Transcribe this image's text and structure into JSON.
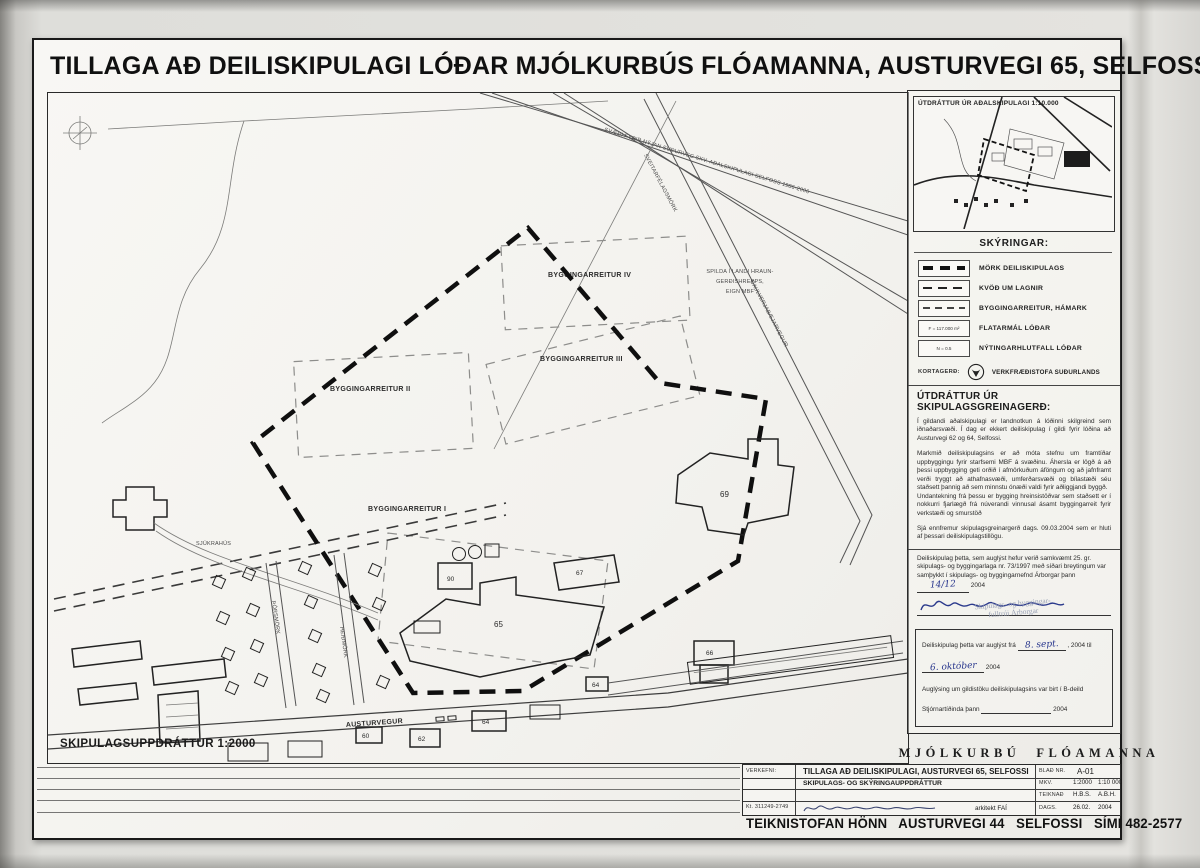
{
  "sheet": {
    "title": "TILLAGA AÐ DEILISKIPULAGI LÓÐAR MJÓLKURBÚS FLÓAMANNA, AUSTURVEGI 65, SELFOSSI"
  },
  "map": {
    "scale_label": "SKIPULAGSUPPDRÁTTUR 1:2000",
    "labels": {
      "byggingarreitur_1": "BYGGINGARREITUR I",
      "byggingarreitur_2": "BYGGINGARREITUR II",
      "byggingarreitur_3": "BYGGINGARREITUR III",
      "byggingarreitur_4": "BYGGINGARREITUR IV",
      "spilda_1": "SPILDA Í LANDI HRAUN-",
      "spilda_2": "GERÐISHREPPS,",
      "spilda_3": "EIGN MBF",
      "sjukrahus": "SJÚKRAHÚS",
      "austurvegur": "AUSTURVEGUR",
      "heidmork": "HEIÐMÖRK",
      "thorsmork": "ÞÓRSMÖRK",
      "sveitarfelagsmork": "SVEITARFÉLAGSMÖRK",
      "sudurvegur": "SVÆÐI FYRIR NÝJAN SUÐURVEG SKV. AÐALSKIPULAGI SELFOSS 1986-2006",
      "gaulverjabaejarvegur": "GAULVERJABÆJARVEGUR"
    },
    "numbers": {
      "n60": "60",
      "n62": "62",
      "n64": "64",
      "n65": "65",
      "n66": "66",
      "n67": "67",
      "n69": "69",
      "n90": "90"
    }
  },
  "inset": {
    "title": "ÚTDRÁTTUR ÚR AÐALSKIPULAGI 1:10.000"
  },
  "legend": {
    "heading": "SKÝRINGAR:",
    "items": [
      {
        "label": "MÖRK DEILISKIPULAGS"
      },
      {
        "label": "KVÖÐ UM LAGNIR"
      },
      {
        "label": "BYGGINGARREITUR, HÁMARK"
      },
      {
        "label": "FLATARMÁL LÓÐAR",
        "symbol_text": "F = 117.000 m²"
      },
      {
        "label": "NÝTINGARHLUTFALL LÓÐAR",
        "symbol_text": "N = 0.5"
      }
    ],
    "kortagerd_label": "KORTAGERÐ:",
    "kortagerd_value": "VERKFRÆÐISTOFA SUÐURLANDS"
  },
  "greinagerd": {
    "heading": "ÚTDRÁTTUR ÚR SKIPULAGSGREINAGERÐ:",
    "p1": "Í gildandi aðalskipulagi er landnotkun á lóðinni skilgreind sem iðnaðarsvæði. Í dag er ekkert deiliskipulag í gildi fyrir lóðina að Austurvegi 62 og 64, Selfossi.",
    "p2": "Markmið deiliskipulagsins er að móta stefnu um framtíðar uppbyggingu fyrir starfsemi MBF á svæðinu.  Áhersla er lögð á að þessi uppbygging geti orðið í afmörkuðum áföngum og að jafnframt verði tryggt að athafnasvæði, umferðarsvæði og bílastæði séu staðsett þannig að sem minnstu ónæði valdi fyrir aðliggjandi byggð.",
    "p3": "Undantekning frá þessu er bygging hreinsistöðvar sem staðsett er í nokkurri fjarlægð frá núverandi vinnusal ásamt byggingarreit fyrir verkstæði og smurstöð",
    "p4": "Sjá ennfremur skipulagsgreinargerð dags. 09.03.2004 sem er hluti af þessari deiliskipulagstillögu."
  },
  "approval": {
    "text1": "Deiliskipulag þetta, sem auglýst hefur verið samkvæmt 25. gr. skipulags- og byggingarlaga nr. 73/1997 með síðari breytingum var samþykkt í skipulags- og byggingarnefnd",
    "text1b": "Árborgar þann",
    "date1": "14/12",
    "year1": "2004",
    "stamp_1": "Skipulags- og byggingar-",
    "stamp_2": "fulltrúi Árborgar",
    "text2": "Deiliskipulag þetta var auglýst frá",
    "date2": "8. sept.",
    "year2": ", 2004 til",
    "date3": "6. október",
    "year3": "2004",
    "text3": "Auglýsing um gildistöku deiliskipulagsins var birt í B-deild",
    "text4": "Stjórnartíðinda þann",
    "year4": "2004"
  },
  "brand": {
    "name_left": "MJÓLKURBÚ",
    "logo_text": "MBF",
    "name_right": "FLÓAMANNA"
  },
  "titleblock": {
    "verkefni_label": "VERKEFNI:",
    "project_line1": "TILLAGA AÐ DEILISKIPULAGI, AUSTURVEGI 65, SELFOSSI",
    "project_line2": "SKIPULAGS- OG SKÝRINGAUPPDRÁTTUR",
    "blad_label": "BLAÐ NR.",
    "blad_value": "A-01",
    "mkv_label": "MKV.",
    "mkv_value1": "1:2000",
    "mkv_value2": "1:10 000",
    "teiknad_label": "TEIKNAÐ",
    "teiknad_value1": "H.B.S.",
    "teiknad_value2": "A.B.H.",
    "dags_label": "DAGS.",
    "dags_value1": "26.02.",
    "dags_value2": "2004",
    "kt": "Kt. 311249-2749",
    "arkitekt": "arkitekt FAÍ",
    "footer": "TEIKNISTOFAN HÖNN   AUSTURVEGI 44   SELFOSSI   SÍMI 482-2577"
  },
  "colors": {
    "ink": "#1c1c1c",
    "handwriting_blue": "#2b3a8c",
    "stamp": "#99a1b5",
    "paper": "#f4f3ef"
  }
}
